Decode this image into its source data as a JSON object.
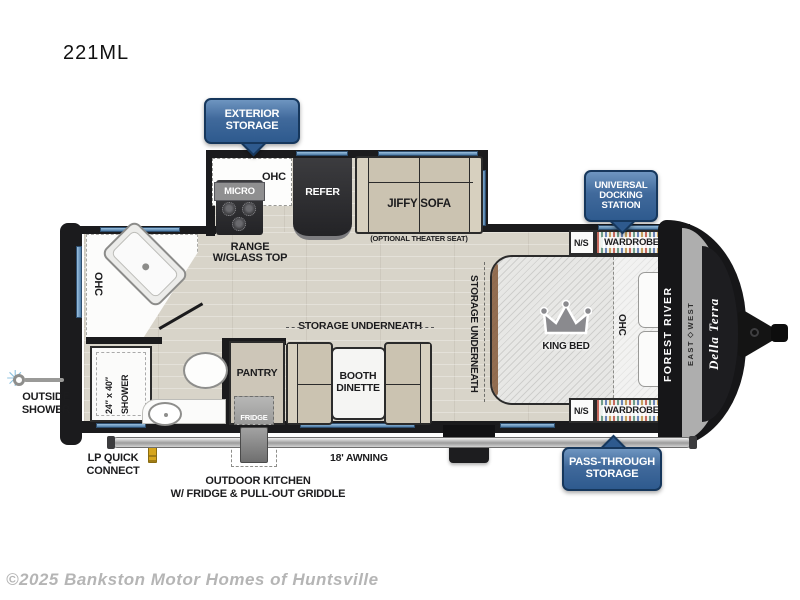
{
  "page": {
    "title": "221ML",
    "watermark": "©2025 Bankston Motor Homes of Huntsville"
  },
  "badges": {
    "exterior_storage": [
      "EXTERIOR",
      "STORAGE"
    ],
    "universal_docking": [
      "UNIVERSAL",
      "DOCKING",
      "STATION"
    ],
    "pass_through": [
      "PASS-THROUGH",
      "STORAGE"
    ]
  },
  "kitchen": {
    "micro": "MICRO",
    "ohc": "OHC",
    "refer": "REFER",
    "range_line1": "RANGE",
    "range_line2": "W/GLASS TOP",
    "counter_ohc": "OHC"
  },
  "living": {
    "sofa": "JIFFY SOFA",
    "sofa_note": "(OPTIONAL THEATER SEAT)",
    "dinette_storage": "STORAGE UNDERNEATH",
    "dinette_line1": "BOOTH",
    "dinette_line2": "DINETTE",
    "pantry": "PANTRY",
    "fridge": "FRIDGE"
  },
  "bath": {
    "shower_line1": "24″ x 40″",
    "shower_line2": "SHOWER"
  },
  "bedroom": {
    "storage": "STORAGE UNDERNEATH",
    "bed": "KING BED",
    "ohc": "OHC",
    "ns_top": "N/S",
    "wardrobe_top": "WARDROBE",
    "ns_bottom": "N/S",
    "wardrobe_bottom": "WARDROBE"
  },
  "exterior": {
    "outside_shower_line1": "OUTSIDE",
    "outside_shower_line2": "SHOWER",
    "lp_line1": "LP QUICK",
    "lp_line2": "CONNECT",
    "outdoor_kitchen_line1": "OUTDOOR KITCHEN",
    "outdoor_kitchen_line2": "W/ FRIDGE & PULL-OUT GRIDDLE",
    "awning": "18' AWNING"
  },
  "brand": {
    "manufacturer": "FOREST RIVER",
    "division": "EAST◇WEST",
    "model": "Della Terra"
  },
  "colors": {
    "badge_blue": "#2e5a8e",
    "wall_black": "#1b1b1d",
    "floor_wood": "#d8d4c9",
    "furniture_tan": "#cbc3b1",
    "window_blue": "#4d7ba6"
  }
}
